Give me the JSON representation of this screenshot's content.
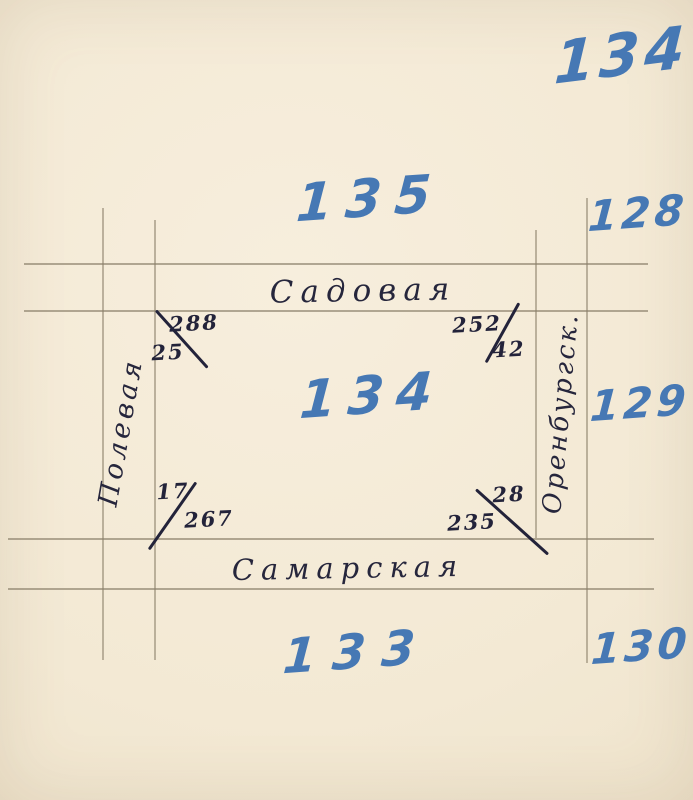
{
  "sketch": {
    "type": "hand-drawn block plan",
    "blocks": {
      "far_top_right": "134",
      "top": "135",
      "north_east": "128",
      "center": "134",
      "east": "129",
      "bottom": "133",
      "south_east": "130"
    },
    "streets": {
      "top": "Садовая",
      "bottom": "Самарская",
      "left": "Полевая",
      "right": "Оренбургск."
    },
    "corner_measurements": {
      "top_left": {
        "upper": "288",
        "lower": "25"
      },
      "top_right": {
        "upper": "252",
        "lower": "42"
      },
      "bottom_left": {
        "upper": "17",
        "lower": "267"
      },
      "bottom_right": {
        "upper": "28",
        "lower": "235"
      }
    },
    "colors": {
      "paper": "#f3e9d4",
      "blue_ink": "#4678b4",
      "black_ink": "#26263c",
      "pencil_line": "#8a806a"
    }
  }
}
